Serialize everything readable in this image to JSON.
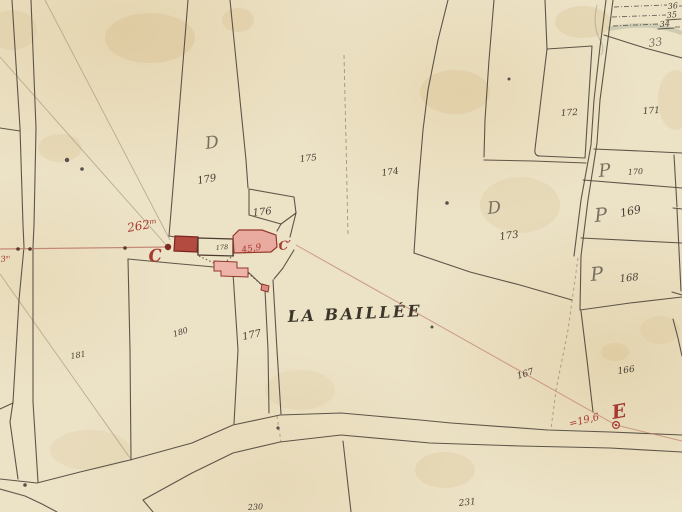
{
  "map": {
    "place_name": "LA BAILLÉE",
    "colors": {
      "paper": "#ece2c6",
      "ink": "#453f35",
      "red": "#a63a31",
      "building_pink": "#e9ab9f",
      "building_solid": "#b44b40"
    },
    "annotations": [
      {
        "name": "strip-number-36",
        "text": "36",
        "x": 668,
        "y": 9,
        "size": 8,
        "rot": -5,
        "cls": "ink"
      },
      {
        "name": "strip-number-35",
        "text": "35",
        "x": 667,
        "y": 18,
        "size": 8,
        "rot": -5,
        "cls": "ink"
      },
      {
        "name": "strip-number-34",
        "text": "34",
        "x": 660,
        "y": 27,
        "size": 8,
        "rot": -5,
        "cls": "ink"
      },
      {
        "name": "parcel-number-33",
        "text": "33",
        "x": 649,
        "y": 47,
        "size": 11,
        "rot": -8,
        "cls": "script"
      },
      {
        "name": "parcel-number-172",
        "text": "172",
        "x": 561,
        "y": 116,
        "size": 9,
        "rot": -4,
        "cls": "ink"
      },
      {
        "name": "parcel-number-171",
        "text": "171",
        "x": 643,
        "y": 114,
        "size": 9,
        "rot": -4,
        "cls": "ink"
      },
      {
        "name": "parcel-number-170",
        "text": "170",
        "x": 628,
        "y": 175,
        "size": 8,
        "rot": -4,
        "cls": "ink"
      },
      {
        "name": "parcel-number-169",
        "text": "169",
        "x": 621,
        "y": 217,
        "size": 11,
        "rot": -12,
        "cls": "ink"
      },
      {
        "name": "parcel-number-168",
        "text": "168",
        "x": 620,
        "y": 282,
        "size": 10,
        "rot": -6,
        "cls": "ink"
      },
      {
        "name": "parcel-number-173",
        "text": "173",
        "x": 500,
        "y": 240,
        "size": 10,
        "rot": -8,
        "cls": "ink"
      },
      {
        "name": "parcel-number-174",
        "text": "174",
        "x": 382,
        "y": 176,
        "size": 9,
        "rot": -8,
        "cls": "ink"
      },
      {
        "name": "parcel-number-175",
        "text": "175",
        "x": 300,
        "y": 162,
        "size": 9,
        "rot": -6,
        "cls": "ink"
      },
      {
        "name": "parcel-number-176",
        "text": "176",
        "x": 253,
        "y": 216,
        "size": 10,
        "rot": -6,
        "cls": "ink"
      },
      {
        "name": "parcel-number-179",
        "text": "179",
        "x": 198,
        "y": 184,
        "size": 10,
        "rot": -10,
        "cls": "ink"
      },
      {
        "name": "parcel-number-177",
        "text": "177",
        "x": 243,
        "y": 340,
        "size": 10,
        "rot": -12,
        "cls": "ink"
      },
      {
        "name": "parcel-number-180",
        "text": "180",
        "x": 174,
        "y": 337,
        "size": 8,
        "rot": -18,
        "cls": "ink"
      },
      {
        "name": "parcel-number-181",
        "text": "181",
        "x": 71,
        "y": 359,
        "size": 8,
        "rot": -10,
        "cls": "ink"
      },
      {
        "name": "parcel-number-167",
        "text": "167",
        "x": 518,
        "y": 379,
        "size": 9,
        "rot": -18,
        "cls": "ink"
      },
      {
        "name": "parcel-number-166",
        "text": "166",
        "x": 618,
        "y": 374,
        "size": 9,
        "rot": -8,
        "cls": "ink"
      },
      {
        "name": "parcel-number-230",
        "text": "230",
        "x": 248,
        "y": 510,
        "size": 8,
        "rot": -3,
        "cls": "ink"
      },
      {
        "name": "parcel-number-231",
        "text": "231",
        "x": 459,
        "y": 506,
        "size": 9,
        "rot": -6,
        "cls": "ink"
      },
      {
        "name": "building-parcel-number-178",
        "text": "178",
        "x": 216,
        "y": 250,
        "size": 6.5,
        "rot": -5,
        "cls": "ink"
      },
      {
        "name": "section-letter-d-west",
        "text": "D",
        "x": 206,
        "y": 149,
        "size": 17,
        "rot": -8,
        "cls": "script"
      },
      {
        "name": "section-letter-d-center",
        "text": "D",
        "x": 488,
        "y": 214,
        "size": 17,
        "rot": -6,
        "cls": "script"
      },
      {
        "name": "owner-letter-p-170",
        "text": "P",
        "x": 599,
        "y": 177,
        "size": 18,
        "rot": -5,
        "cls": "script"
      },
      {
        "name": "owner-letter-p-169",
        "text": "P",
        "x": 595,
        "y": 222,
        "size": 19,
        "rot": -5,
        "cls": "script"
      },
      {
        "name": "owner-letter-p-168",
        "text": "P",
        "x": 591,
        "y": 281,
        "size": 19,
        "rot": -5,
        "cls": "script"
      },
      {
        "name": "red-measure-262m",
        "text": "262ᵐ",
        "x": 128,
        "y": 232,
        "size": 12,
        "rot": -10,
        "cls": "red"
      },
      {
        "name": "red-letter-c",
        "text": "C",
        "x": 149,
        "y": 262,
        "size": 17,
        "rot": -5,
        "cls": "red-script"
      },
      {
        "name": "red-letter-c-prime",
        "text": "C′",
        "x": 279,
        "y": 250,
        "size": 12,
        "rot": -5,
        "cls": "red-script"
      },
      {
        "name": "red-measure-45-9",
        "text": "45,9",
        "x": 242,
        "y": 253,
        "size": 9,
        "rot": -10,
        "cls": "red"
      },
      {
        "name": "red-letter-e",
        "text": "E",
        "x": 613,
        "y": 419,
        "size": 19,
        "rot": -10,
        "cls": "red-script"
      },
      {
        "name": "red-measure-19-6",
        "text": "=19,6",
        "x": 570,
        "y": 427,
        "size": 10,
        "rot": -14,
        "cls": "red"
      },
      {
        "name": "red-measure-3m",
        "text": "3ᵐ",
        "x": 1,
        "y": 262,
        "size": 8,
        "rot": -8,
        "cls": "red"
      },
      {
        "name": "place-name-label",
        "text": "LA BAILLÉE",
        "x": 288,
        "y": 322,
        "size": 16,
        "rot": -2.5,
        "cls": "place"
      }
    ]
  }
}
